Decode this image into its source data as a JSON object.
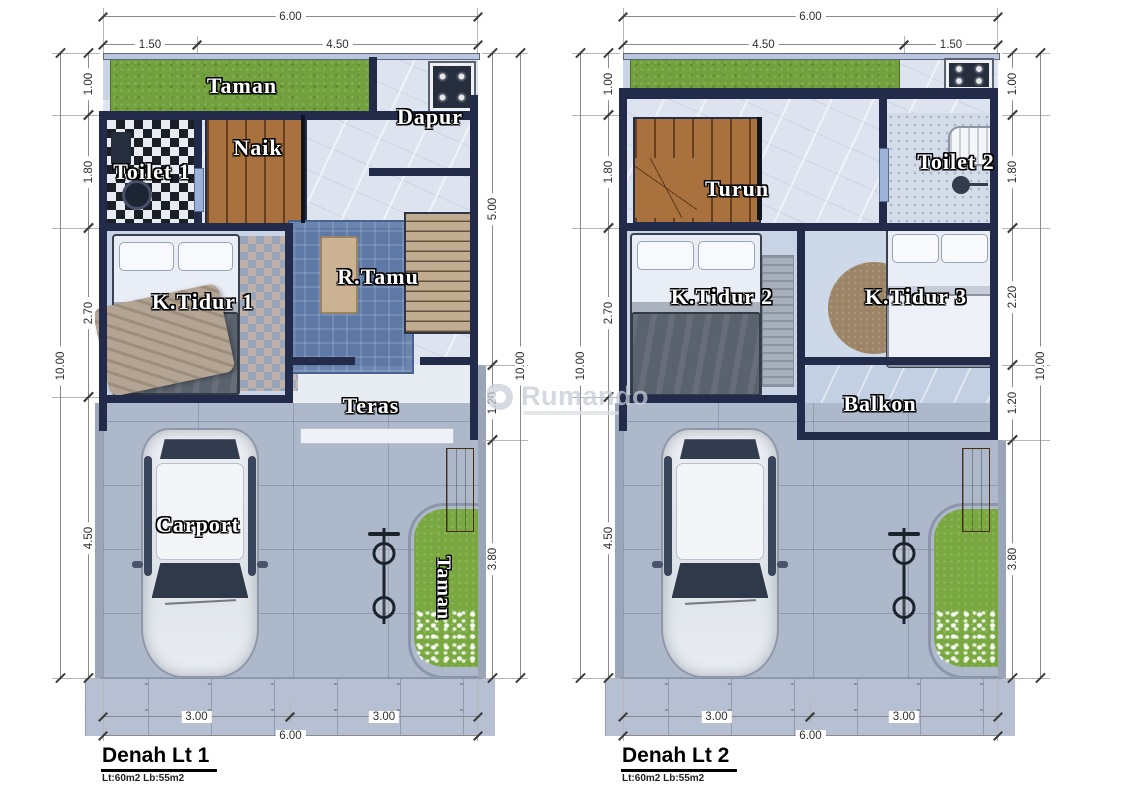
{
  "watermark": {
    "name": "Rumando"
  },
  "plan1": {
    "title": "Denah Lt 1",
    "area_note": "Lt:60m2 Lb:55m2",
    "rooms": {
      "garden_top": "Taman",
      "kitchen": "Dapur",
      "stairs": "Naik",
      "toilet": "Toilet 1",
      "bedroom": "K.Tidur 1",
      "living": "R.Tamu",
      "terrace": "Teras",
      "carport": "Carport",
      "garden_side": "Taman"
    },
    "dims": {
      "top_total": "6.00",
      "top_a": "1.50",
      "top_b": "4.50",
      "left_a": "1.00",
      "left_b": "1.80",
      "left_c": "2.70",
      "left_d": "4.50",
      "left_total": "10.00",
      "right_a": "5.00",
      "right_b": "1.20",
      "right_c": "3.80",
      "right_total": "10.00",
      "bottom_a": "3.00",
      "bottom_b": "3.00",
      "bottom_total": "6.00"
    }
  },
  "plan2": {
    "title": "Denah Lt 2",
    "area_note": "Lt:60m2 Lb:55m2",
    "rooms": {
      "stairs": "Turun",
      "toilet": "Toilet 2",
      "bedroom2": "K.Tidur 2",
      "bedroom3": "K.Tidur 3",
      "balcony": "Balkon"
    },
    "dims": {
      "top_total": "6.00",
      "top_a": "4.50",
      "top_b": "1.50",
      "left_a": "1.00",
      "left_b": "1.80",
      "left_c": "2.70",
      "left_d": "4.50",
      "left_total": "10.00",
      "right_a": "1.00",
      "right_b": "1.80",
      "right_c": "2.20",
      "right_d": "1.20",
      "right_e": "3.80",
      "right_total": "10.00",
      "bottom_a": "3.00",
      "bottom_b": "3.00",
      "bottom_total": "6.00"
    }
  },
  "colors": {
    "wall": "#222c4a",
    "floor": "#dde4ef",
    "garden": "#71a03c",
    "wood": "#a9713e",
    "paving": "#adb8cb",
    "rug": "#5e79a6"
  }
}
